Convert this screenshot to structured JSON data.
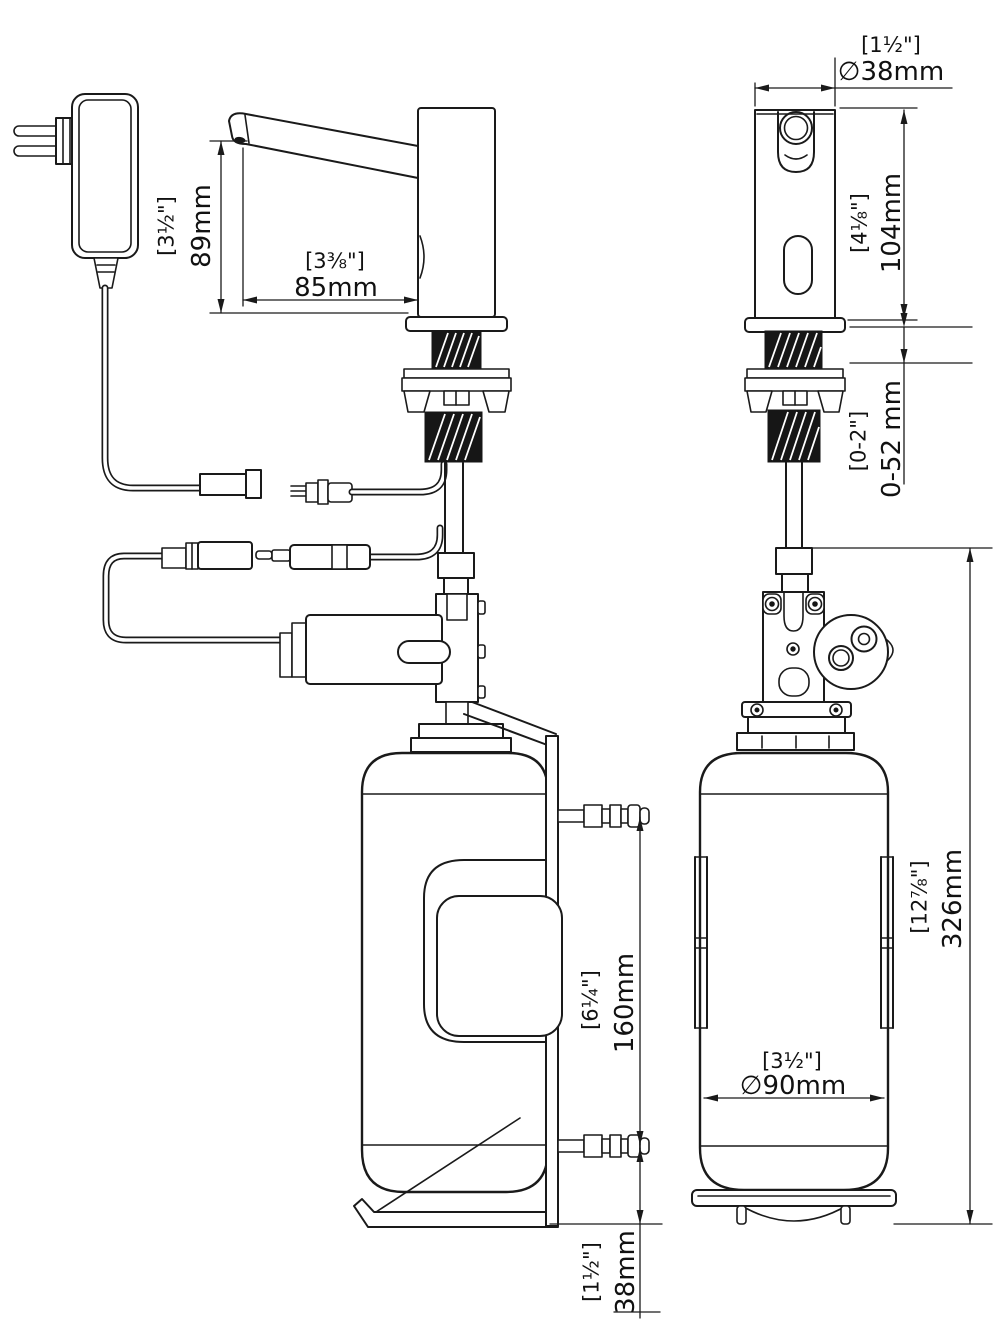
{
  "meta": {
    "background": "#ffffff",
    "line_color": "#1a1a1a",
    "drawing_type": "sensor soap dispenser installation dimensions"
  },
  "dimensions": {
    "spout_height": {
      "inch": "[3½\"]",
      "mm": "89mm"
    },
    "spout_reach": {
      "inch": "[3⅜\"]",
      "mm": "85mm"
    },
    "spout_diameter": {
      "inch": "[1½\"]",
      "mm": "∅38mm"
    },
    "spout_body_height": {
      "inch": "[4⅛\"]",
      "mm": "104mm"
    },
    "deck_thickness": {
      "inch": "[0-2\"]",
      "mm": "0-52 mm"
    },
    "bracket_screw_spacing": {
      "inch": "[6¼\"]",
      "mm": "160mm"
    },
    "bottle_height": {
      "inch": "[12⅞\"]",
      "mm": "326mm"
    },
    "bottle_diameter": {
      "inch": "[3½\"]",
      "mm": "∅90mm"
    },
    "bracket_bottom_offset": {
      "inch": "[1½\"]",
      "mm": "38mm"
    }
  }
}
